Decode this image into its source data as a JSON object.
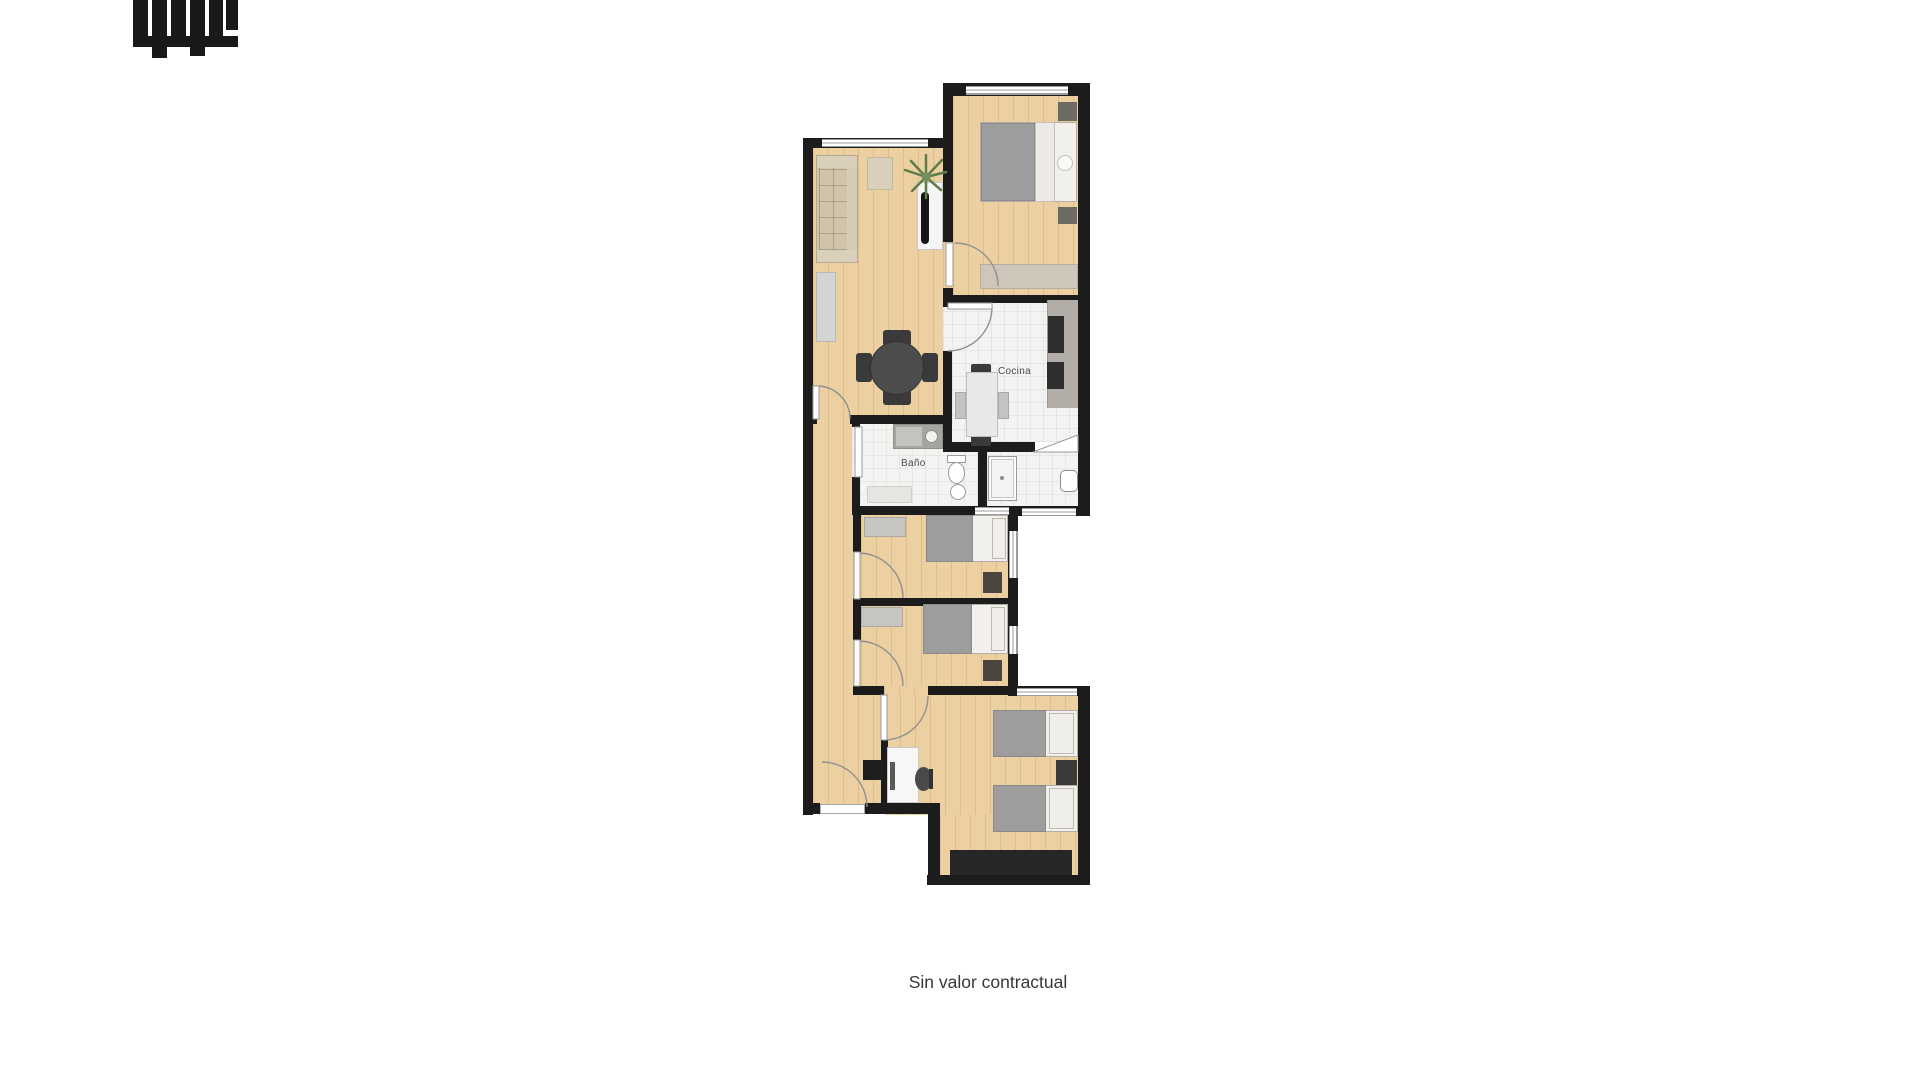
{
  "page": {
    "background": "#ffffff",
    "caption": "Sin valor contractual"
  },
  "floorplan": {
    "labels": {
      "kitchen": "Cocina",
      "bathroom": "Baño"
    },
    "colors": {
      "wall": "#1c1c1c",
      "wood_floor": "#ecd0a2",
      "tile_floor": "#f3f3f1",
      "counter": "#b2aea7",
      "sofa": "#cfc3ac",
      "bed_duvet": "#9d9d9d",
      "bed_linen": "#f1f0ed",
      "light_furniture": "#c6c5c1",
      "dark_furniture": "#3a3a3a",
      "plant": "#5f7d49",
      "door_swing": "#909090"
    }
  }
}
